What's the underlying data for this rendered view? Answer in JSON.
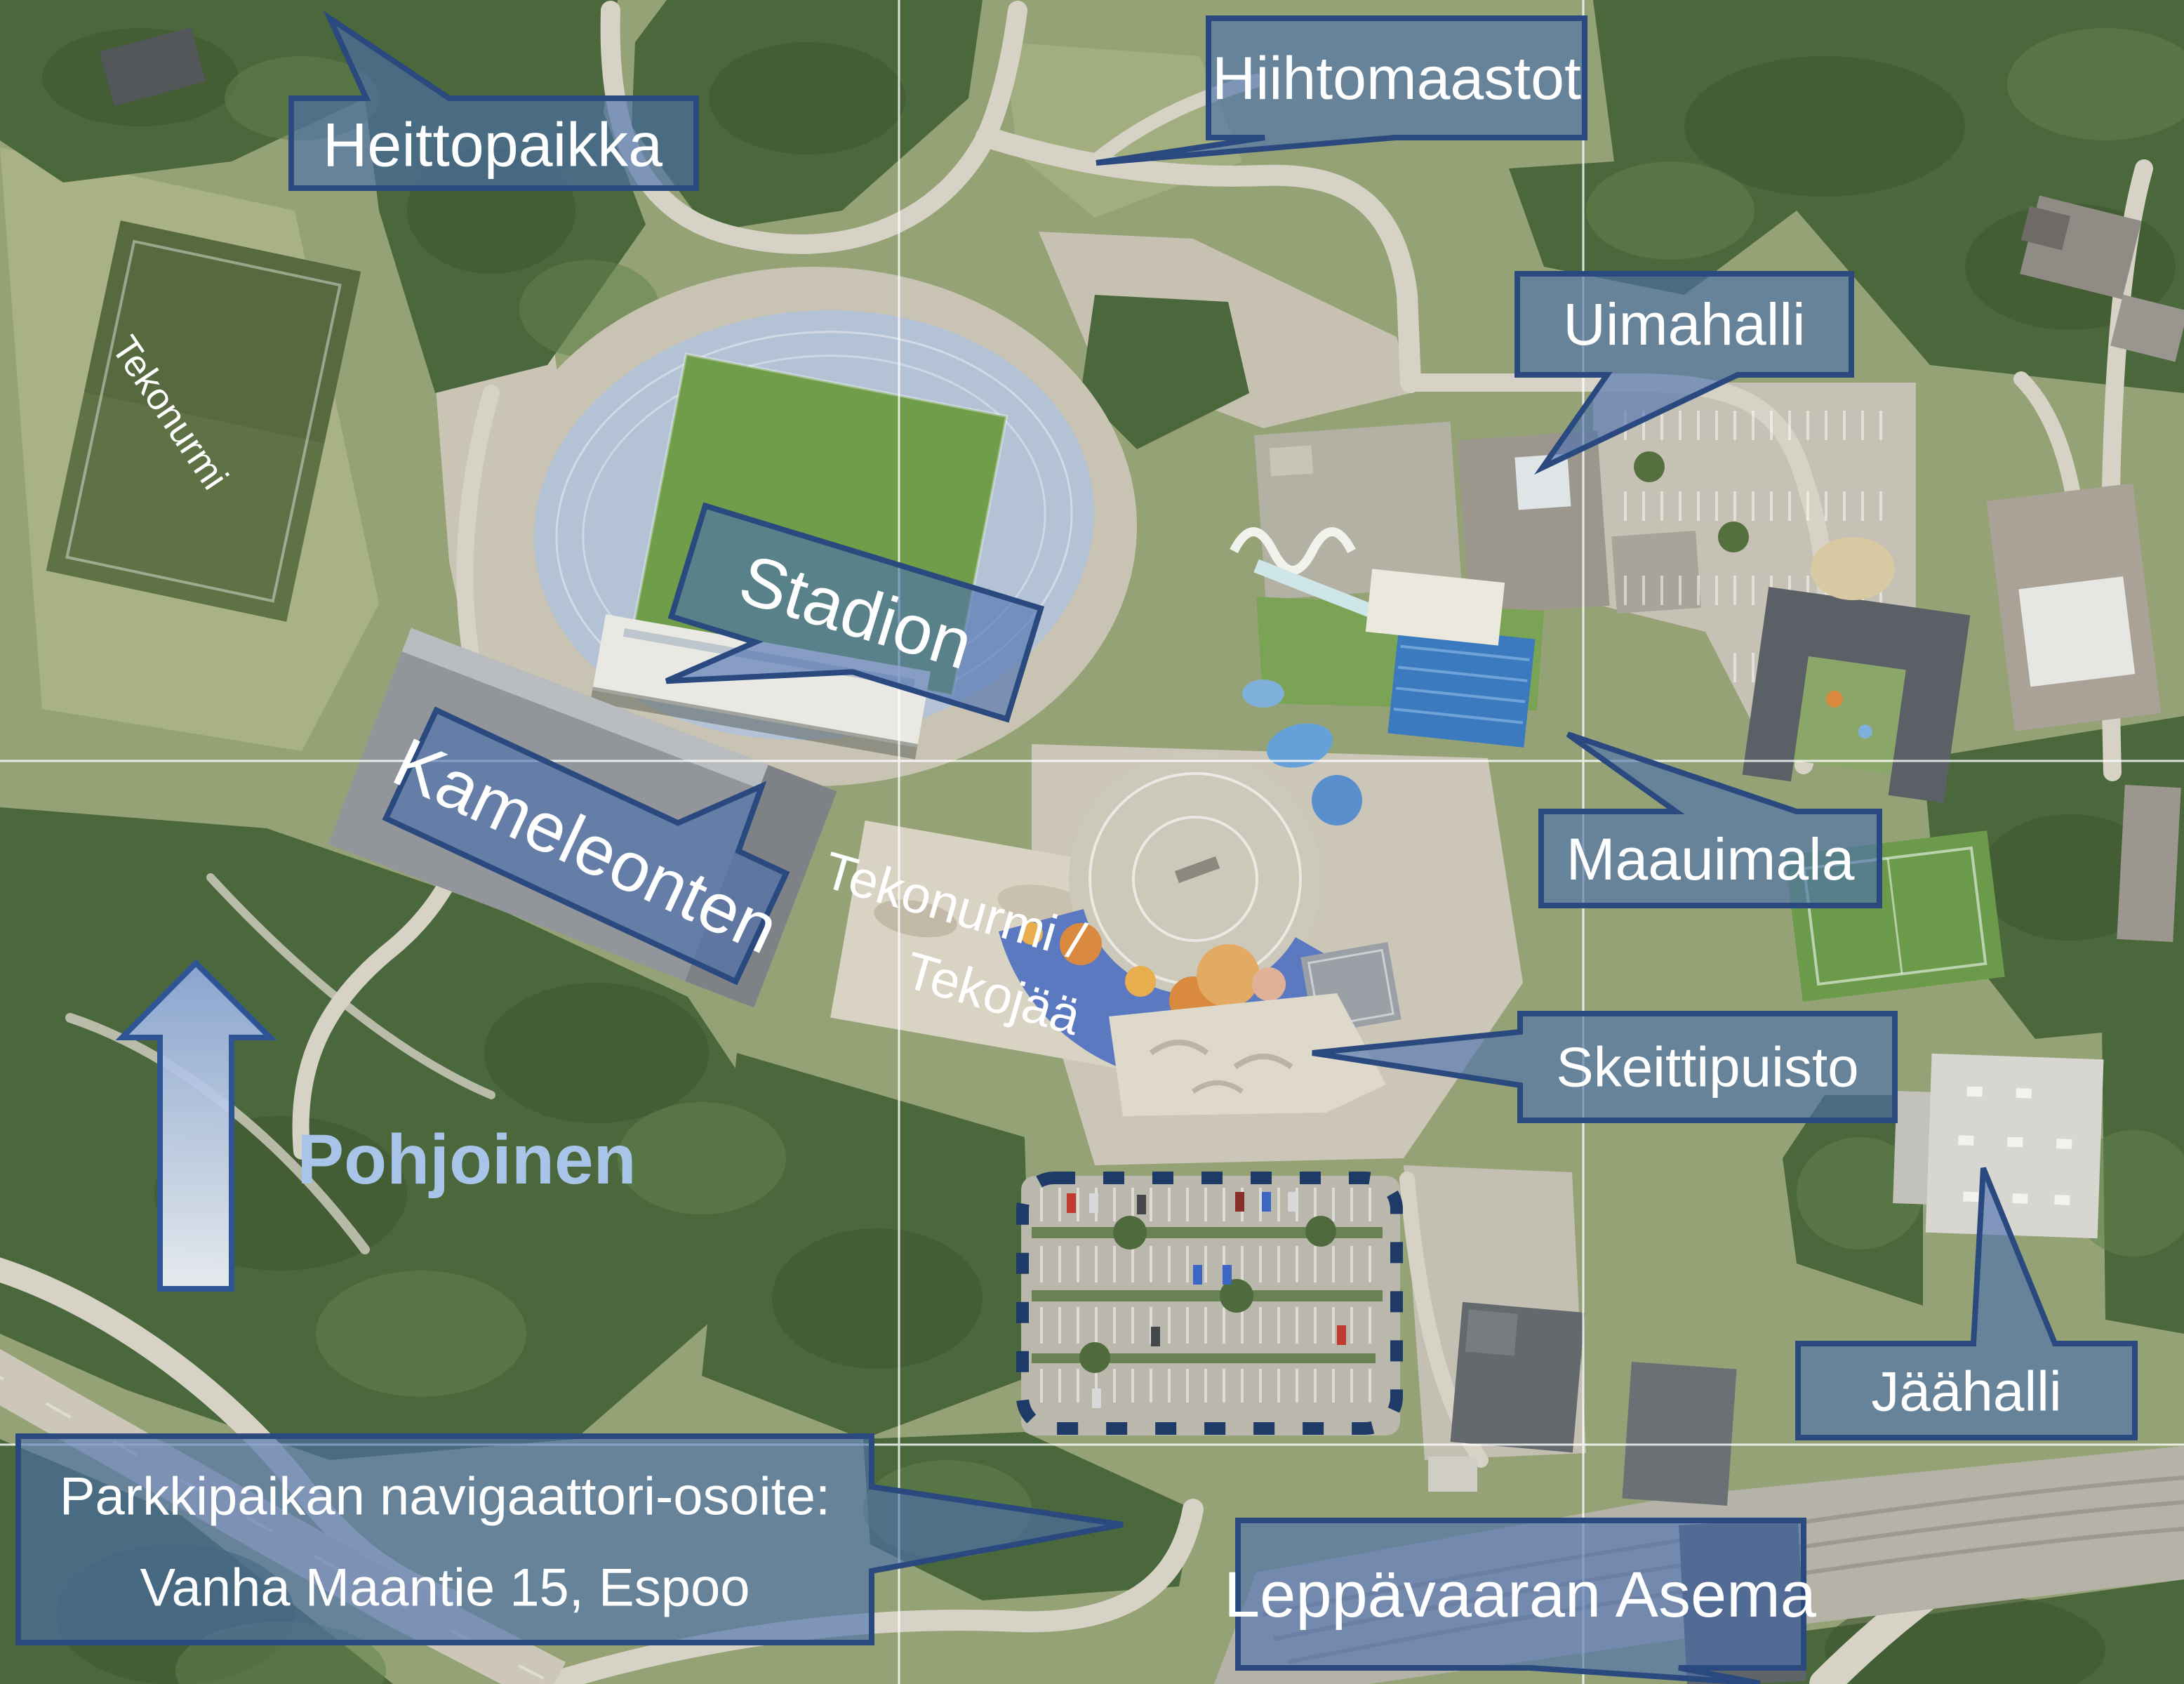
{
  "map": {
    "callouts": {
      "heittopaikka": "Heittopaikka",
      "hiihtomaastot": "Hiihtomaastot",
      "uimahalli": "Uimahalli",
      "stadion": "Stadion",
      "kameleonten": "Kameleonten",
      "maauimala": "Maauimala",
      "skeittipuisto": "Skeittipuisto",
      "jaahalli": "Jäähalli",
      "leppavaaran_asema": "Leppävaaran Asema",
      "parking_line1": "Parkkipaikan navigaattori-osoite:",
      "parking_line2": "Vanha Maantie 15, Espoo"
    },
    "ground_labels": {
      "tekonurmi_field": "Tekonurmi",
      "tekojaa_line1": "Tekonurmi /",
      "tekojaa_line2": "Tekojää"
    },
    "compass": {
      "label": "Pohjoinen"
    },
    "colors": {
      "callout_fill": "#4a70b0",
      "callout_border": "#29497f",
      "callout_text": "#ffffff",
      "compass_text": "#a9c4e9",
      "north_arrow_border": "#2e5496",
      "dashed_outline": "#1e3a66",
      "gridline": "#ffffff"
    }
  }
}
